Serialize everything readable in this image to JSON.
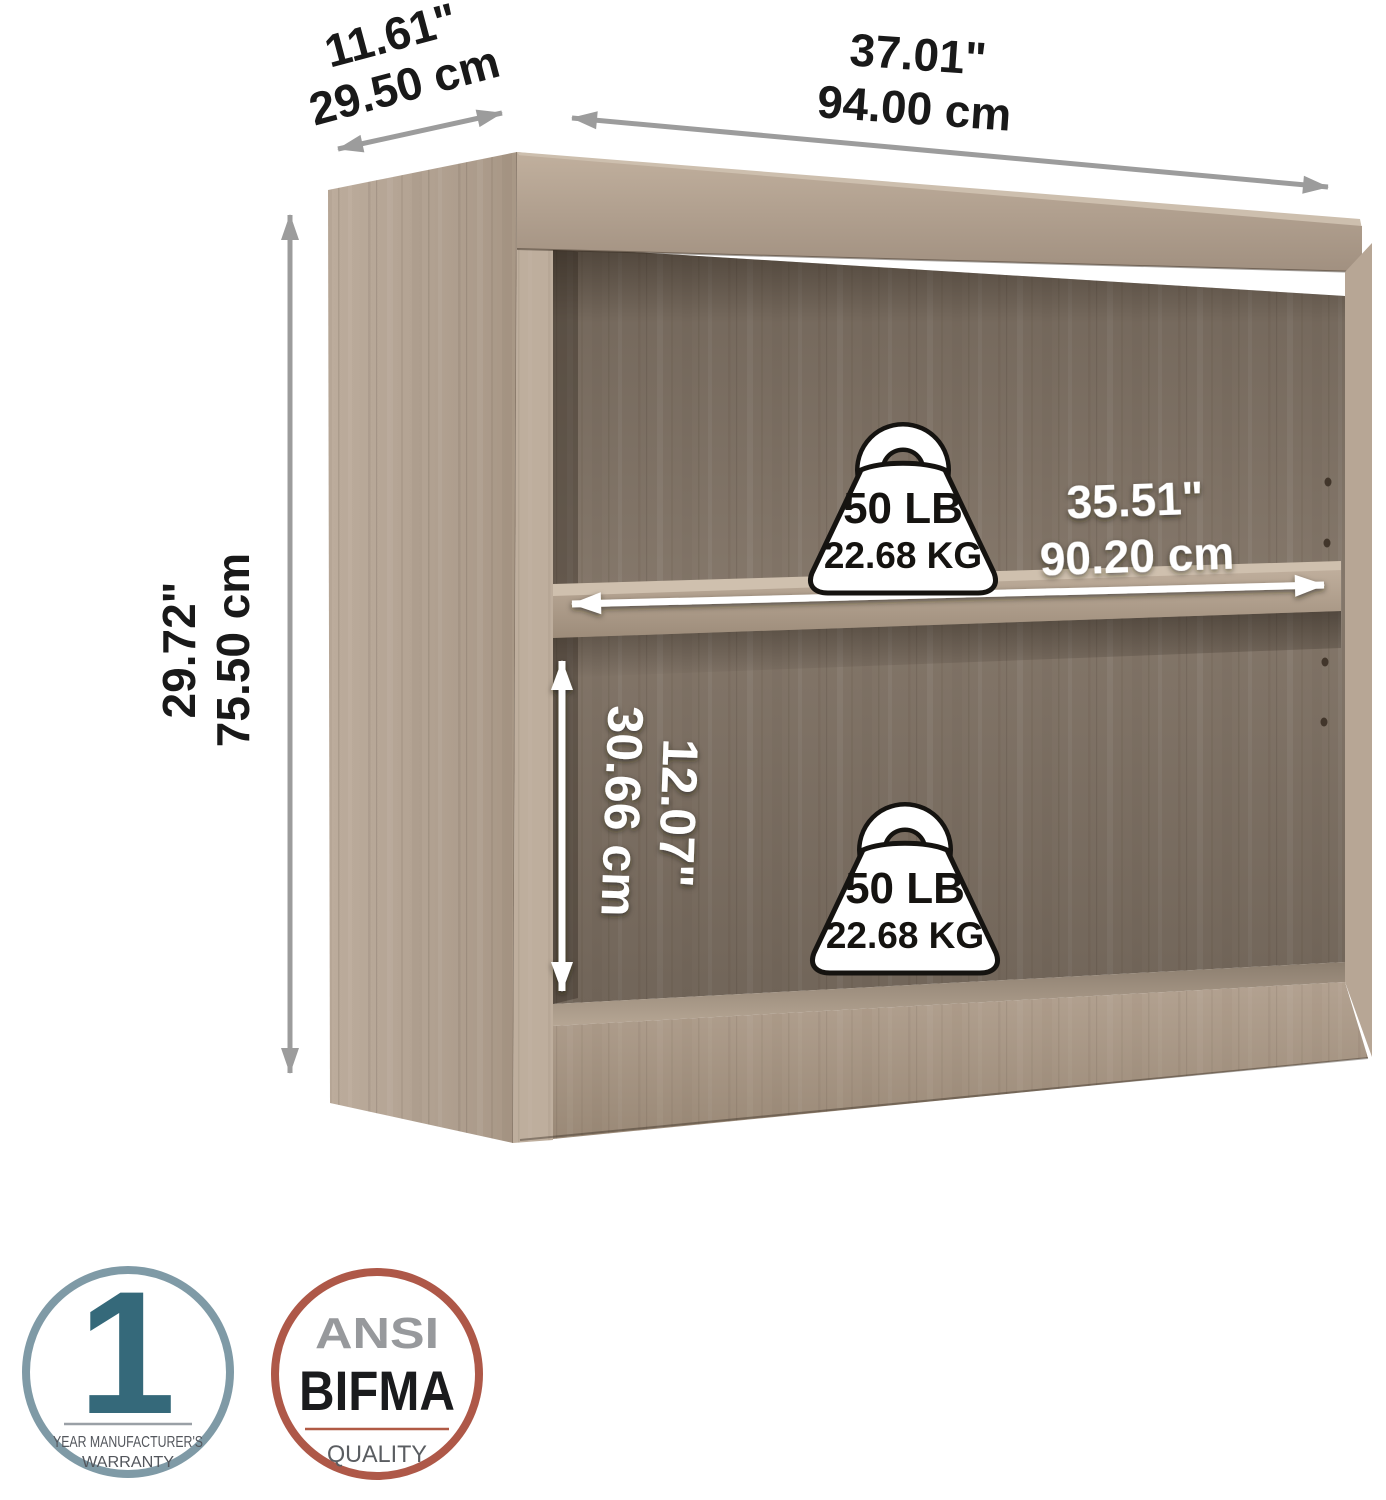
{
  "dim": {
    "depth_in": "11.61\"",
    "depth_cm": "29.50 cm",
    "width_in": "37.01\"",
    "width_cm": "94.00 cm",
    "height_in": "29.72\"",
    "height_cm": "75.50 cm",
    "shelf_width_in": "35.51\"",
    "shelf_width_cm": "90.20 cm",
    "clearance_in": "12.07\"",
    "clearance_cm": "30.66 cm"
  },
  "capacity": {
    "upper_lb": "50 LB",
    "upper_kg": "22.68 KG",
    "lower_lb": "50 LB",
    "lower_kg": "22.68 KG"
  },
  "badges": {
    "warranty_number": "1",
    "warranty_line1": "YEAR MANUFACTURER'S",
    "warranty_line2": "WARRANTY",
    "quality_line1": "ANSI",
    "quality_line2": "BIFMA",
    "quality_line3": "QUALITY"
  },
  "colors": {
    "warranty_ring": "#7f9aa6",
    "warranty_accent": "#35697a",
    "quality_ring": "#ae5848",
    "ansi_gray": "#97999c",
    "bifma_black": "#1a1b1d",
    "arrow_gray": "#9c9c9c",
    "wood_side": "#b2a292",
    "wood_interior": "#84776a",
    "dimension_text": "#191919",
    "dimension_text_on_wood": "#ffffff"
  }
}
